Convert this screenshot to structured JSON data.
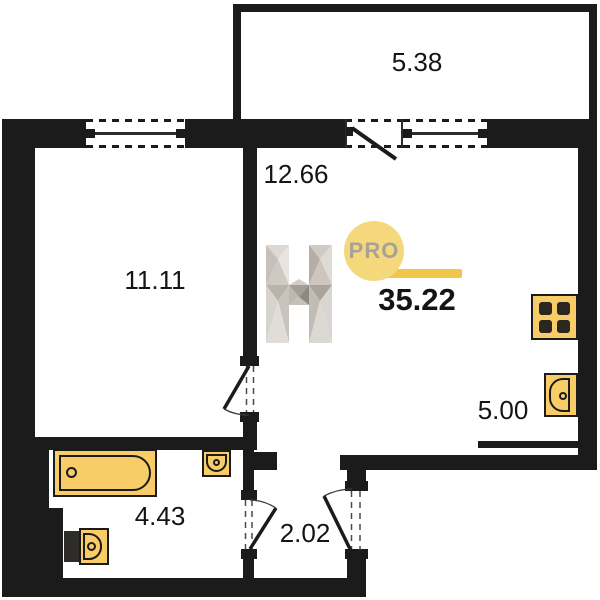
{
  "plan": {
    "watermark": {
      "logo_letter": "H",
      "badge": "PRO",
      "total_area": "35.22"
    },
    "rooms": {
      "balcony": "5.38",
      "living_room": "12.66",
      "bedroom": "11.11",
      "kitchen_zone": "5.00",
      "bathroom": "4.43",
      "hallway": "2.02"
    },
    "colors": {
      "wall": "#1b1b1b",
      "fixture-fill": "#f8cd68",
      "fixture-stroke": "#1b1b1b",
      "badge-bg": "#f5d77c",
      "badge-text": "#a7a298",
      "underline": "#f2c64a",
      "label": "#141414"
    }
  }
}
